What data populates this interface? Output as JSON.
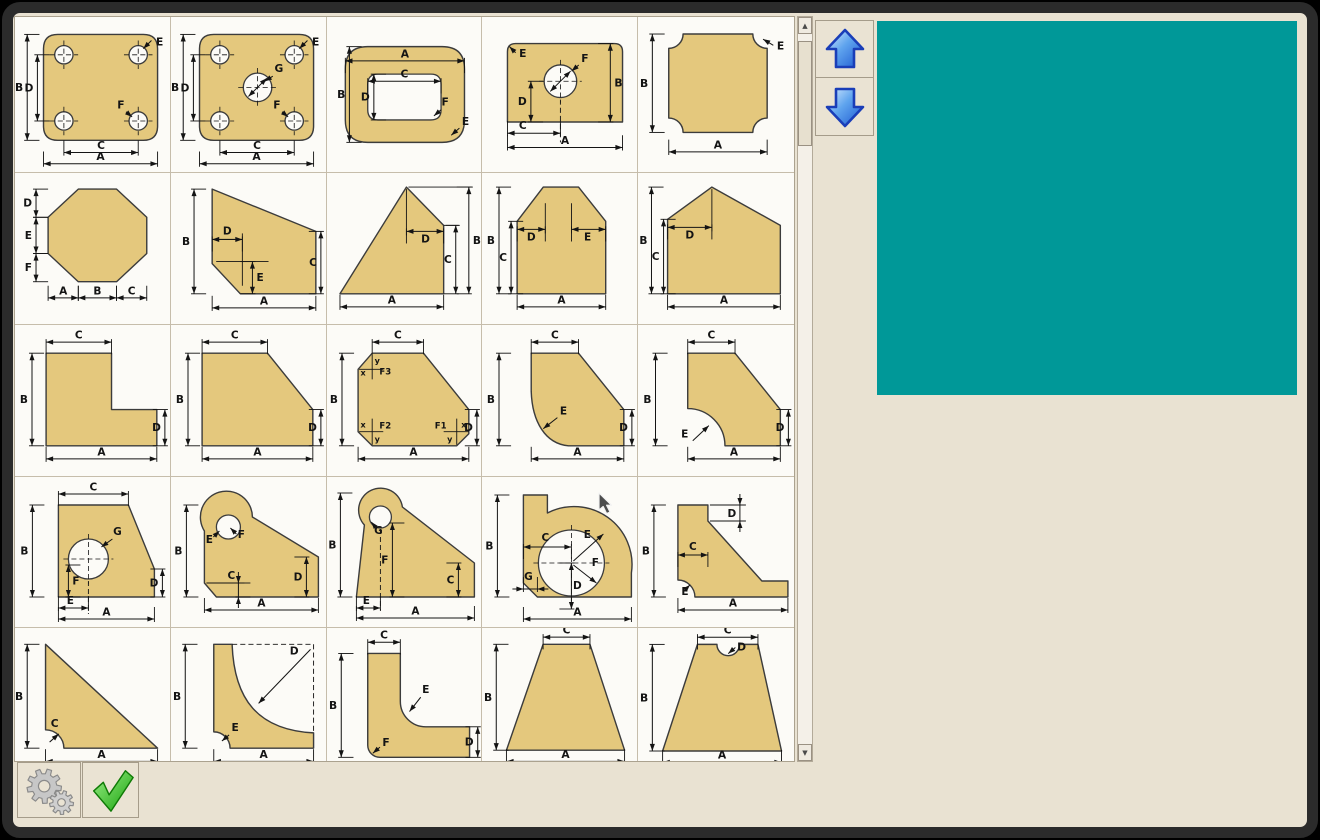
{
  "window": {
    "frame_color": "#2B2B2B",
    "bg_color": "#E9E2D2"
  },
  "palette": {
    "shape_fill": "#E4C87D",
    "shape_stroke": "#3C3C3C",
    "dim_color": "#141414",
    "cell_bg": "#FCFBF7",
    "grid_line": "#C6BDAB"
  },
  "preview": {
    "color": "#009898"
  },
  "scrollbar": {
    "up_glyph": "▲",
    "down_glyph": "▼"
  },
  "nav": {
    "up": "scroll-shapes-up",
    "down": "scroll-shapes-down"
  },
  "actions": {
    "settings": "settings",
    "confirm": "confirm-selection"
  },
  "shapes": [
    {
      "name": "plate-four-holes",
      "labels": [
        "B",
        "D",
        "E",
        "F",
        "C",
        "A"
      ]
    },
    {
      "name": "plate-four-holes-center-hole",
      "labels": [
        "B",
        "D",
        "G",
        "E",
        "F",
        "C",
        "A"
      ]
    },
    {
      "name": "rounded-plate-rounded-slot",
      "labels": [
        "A",
        "C",
        "B",
        "D",
        "F",
        "E"
      ]
    },
    {
      "name": "plate-single-hole",
      "labels": [
        "E",
        "F",
        "B",
        "D",
        "C",
        "A"
      ]
    },
    {
      "name": "scalloped-corner-square",
      "labels": [
        "E",
        "B",
        "A"
      ]
    },
    {
      "name": "octagon",
      "labels": [
        "D",
        "E",
        "F",
        "A",
        "B",
        "C"
      ]
    },
    {
      "name": "slant-top-plate-notch",
      "labels": [
        "B",
        "D",
        "E",
        "C",
        "A"
      ]
    },
    {
      "name": "peaked-right-triangle",
      "labels": [
        "D",
        "B",
        "C",
        "A"
      ]
    },
    {
      "name": "double-chamfer-gable",
      "labels": [
        "B",
        "C",
        "D",
        "E",
        "A"
      ]
    },
    {
      "name": "gable-pentagon",
      "labels": [
        "B",
        "C",
        "D",
        "A"
      ]
    },
    {
      "name": "l-plate",
      "labels": [
        "C",
        "B",
        "D",
        "A"
      ]
    },
    {
      "name": "chamfer-corner-plate",
      "labels": [
        "C",
        "B",
        "D",
        "A"
      ]
    },
    {
      "name": "triple-chamfer-plate",
      "labels": [
        "C",
        "B",
        "D",
        "A",
        "F3",
        "F2",
        "F1",
        "x",
        "y"
      ]
    },
    {
      "name": "fillet-corner-plate",
      "labels": [
        "C",
        "B",
        "E",
        "D",
        "A"
      ]
    },
    {
      "name": "quarter-notch-plate",
      "labels": [
        "C",
        "B",
        "E",
        "D",
        "A"
      ]
    },
    {
      "name": "chamfer-plate-hole",
      "labels": [
        "C",
        "B",
        "G",
        "F",
        "E",
        "D",
        "A"
      ]
    },
    {
      "name": "lobe-bracket",
      "labels": [
        "E",
        "F",
        "B",
        "C",
        "D",
        "A"
      ]
    },
    {
      "name": "slant-lobe-bracket",
      "labels": [
        "B",
        "G",
        "F",
        "C",
        "E",
        "A"
      ]
    },
    {
      "name": "bearing-block",
      "labels": [
        "B",
        "C",
        "E",
        "F",
        "D",
        "G",
        "A"
      ]
    },
    {
      "name": "angle-gusset",
      "labels": [
        "B",
        "D",
        "C",
        "E",
        "A"
      ]
    },
    {
      "name": "triangle-gusset",
      "labels": [
        "B",
        "C",
        "A"
      ]
    },
    {
      "name": "concave-gusset",
      "labels": [
        "B",
        "D",
        "E",
        "A"
      ]
    },
    {
      "name": "l-bracket-fillet",
      "labels": [
        "C",
        "B",
        "E",
        "F",
        "D"
      ]
    },
    {
      "name": "trapezoid",
      "labels": [
        "C",
        "B",
        "A"
      ]
    },
    {
      "name": "trapezoid-notch",
      "labels": [
        "C",
        "D",
        "B",
        "A"
      ]
    }
  ]
}
